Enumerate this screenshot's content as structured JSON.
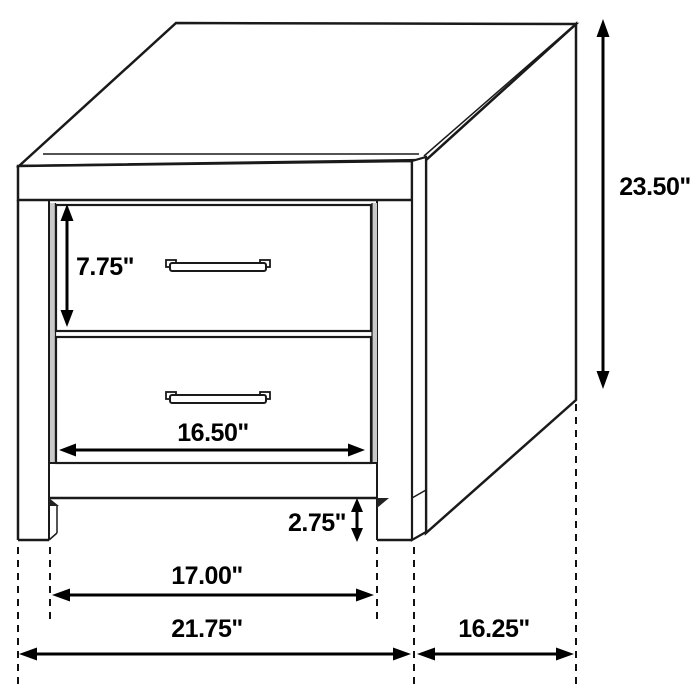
{
  "diagram": {
    "background": "#ffffff",
    "line_color": "#1a1a1a",
    "text_color": "#000000",
    "dash_pattern": "dashed-extension-lines"
  },
  "dimensions": {
    "overall_height": "23.50\"",
    "drawer_opening_height": "7.75\"",
    "drawer_front_width": "16.50\"",
    "foot_height": "2.75\"",
    "between_legs_width": "17.00\"",
    "overall_width": "21.75\"",
    "side_depth": "16.25\""
  }
}
